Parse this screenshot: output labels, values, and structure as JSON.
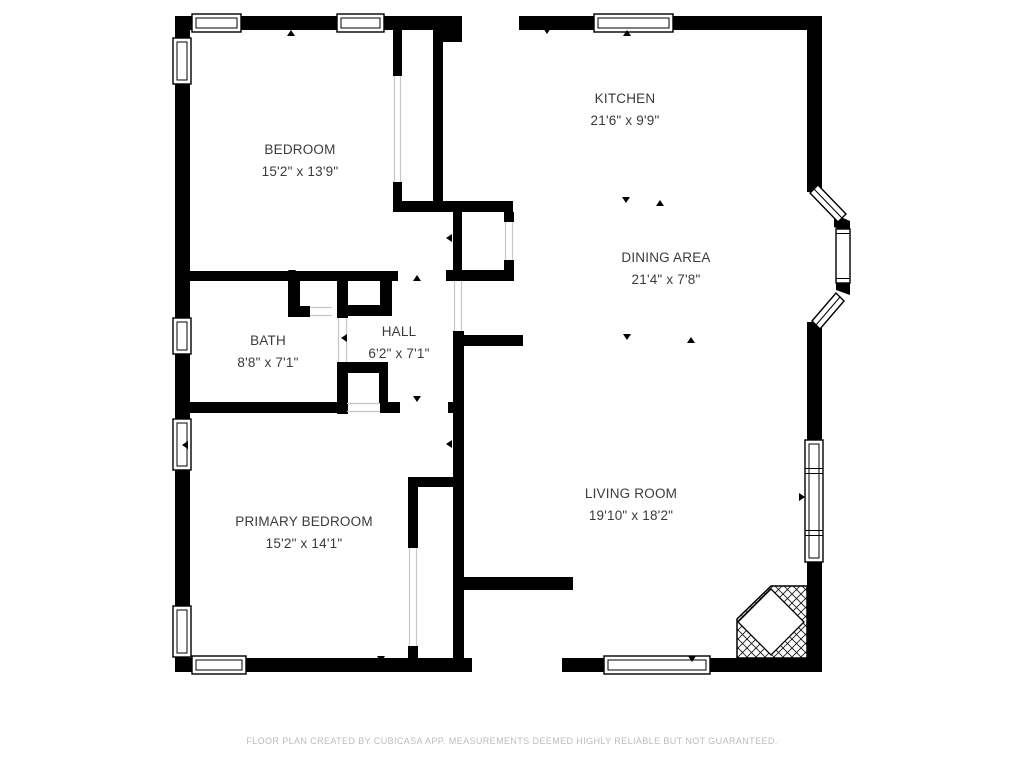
{
  "rooms": {
    "bedroom": {
      "name": "BEDROOM",
      "dims": "15'2\" x 13'9\""
    },
    "kitchen": {
      "name": "KITCHEN",
      "dims": "21'6\" x 9'9\""
    },
    "dining": {
      "name": "DINING AREA",
      "dims": "21'4\" x 7'8\""
    },
    "bath": {
      "name": "BATH",
      "dims": "8'8\" x 7'1\""
    },
    "hall": {
      "name": "HALL",
      "dims": "6'2\" x 7'1\""
    },
    "primary": {
      "name": "PRIMARY BEDROOM",
      "dims": "15'2\" x 14'1\""
    },
    "living": {
      "name": "LIVING ROOM",
      "dims": "19'10\" x 18'2\""
    }
  },
  "footer": {
    "disclaimer": "FLOOR PLAN CREATED BY CUBICASA APP. MEASUREMENTS DEEMED HIGHLY RELIABLE BUT NOT GUARANTEED."
  },
  "colors": {
    "wall": "#000000",
    "label_text": "#3b3b3b",
    "footer_text": "#bcbcbc",
    "opening_line": "#c6c6c6",
    "background": "#ffffff"
  }
}
